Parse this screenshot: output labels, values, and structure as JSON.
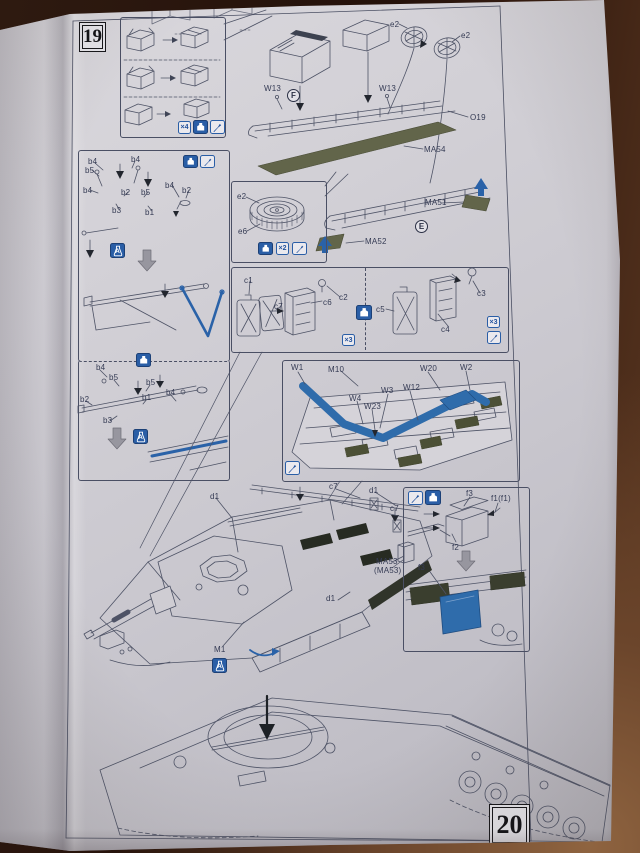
{
  "steps": {
    "current": "19",
    "next": "20"
  },
  "circled_letters": {
    "front_rack": "F",
    "rear_rack": "E"
  },
  "quantities": {
    "boxes": "×4",
    "drum": "×2",
    "cans_left": "×3",
    "cans_right": "×3"
  },
  "paint_marks": {
    "bracket": "A",
    "rail": "A",
    "turret": "A"
  },
  "top_assembly": {
    "e2_left": "e2",
    "e2_right": "e2",
    "w13_left": "W13",
    "w13_right": "W13",
    "o19": "O19",
    "ma54": "MA54",
    "ma51": "MA51",
    "ma52": "MA52"
  },
  "drum_panel": {
    "e2": "e2",
    "e6": "e6"
  },
  "bracket_panel": {
    "labels": [
      "b4",
      "b4",
      "b5",
      "b4",
      "b2",
      "b3",
      "b5",
      "b1",
      "b4",
      "b2"
    ]
  },
  "rail_panel": {
    "labels": [
      "b4",
      "b5",
      "b5",
      "b1",
      "b4",
      "b2",
      "b3"
    ]
  },
  "cans_panel": {
    "left": [
      "c1",
      "c7",
      "c6",
      "c2"
    ],
    "right": [
      "c5",
      "c3",
      "c4"
    ]
  },
  "w_panel": {
    "labels": [
      "W1",
      "M10",
      "W20",
      "W2",
      "W3",
      "W12",
      "W4",
      "W23"
    ]
  },
  "f_panel": {
    "top": "f3",
    "f1": "f1(f1)",
    "f2": "f2",
    "bottom": "f3"
  },
  "hull": {
    "d1_left": "d1",
    "c7_top": "c7",
    "d1_right": "d1",
    "c7_right": "c7",
    "ma53": "MA53",
    "ma53_paren": "(MA53)",
    "d1_lower": "d1",
    "m1": "M1"
  },
  "icon_legend": {
    "glue": "apply-cement-icon",
    "knife": "trim-with-knife-icon",
    "paint": "paint-color-icon",
    "rotate": "rotate-arrow"
  },
  "colors": {
    "accent_blue": "#2a62a8",
    "photo_etch_green": "#62654a",
    "paper": "#cdcbd1",
    "table": "#3a2012"
  }
}
